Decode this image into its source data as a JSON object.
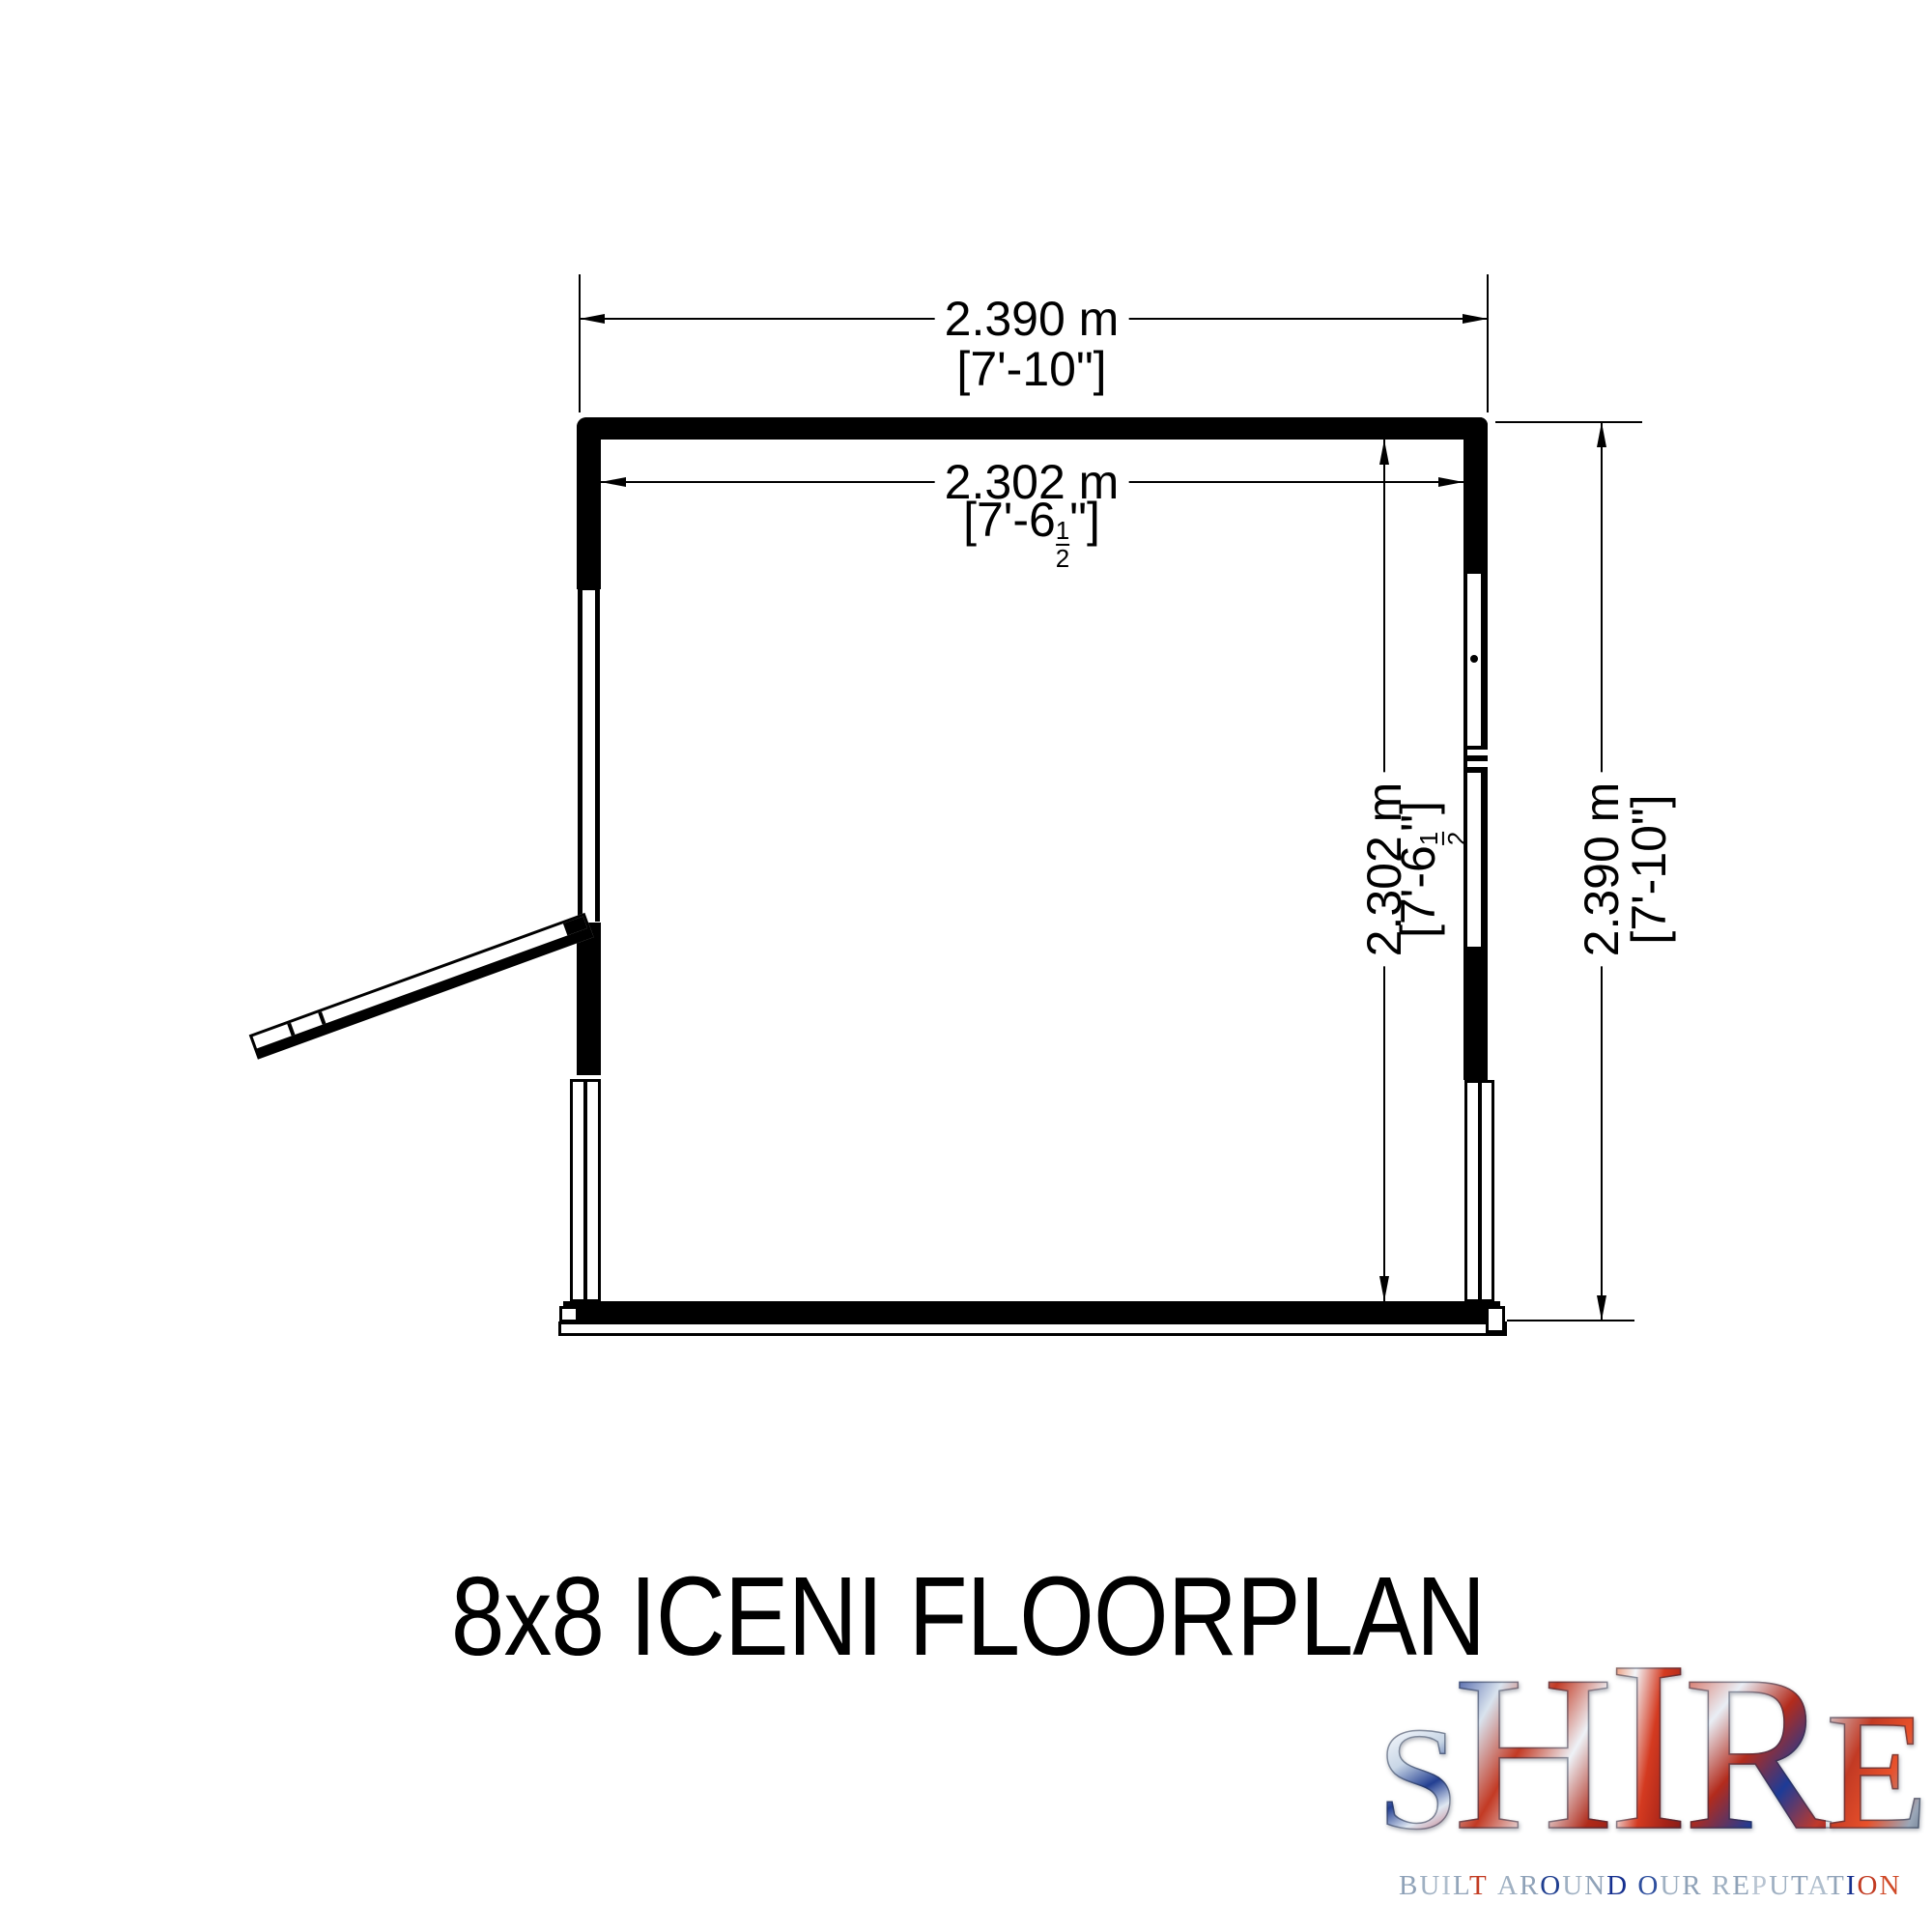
{
  "title": "8x8 ICENI FLOORPLAN",
  "dimensions": {
    "top": {
      "metric": "2.390 m",
      "imperial": {
        "pre": "[7'-10",
        "post": "\"]"
      }
    },
    "inner_width": {
      "metric": "2.302 m",
      "imperial": {
        "pre": "[7'-6",
        "num": "1",
        "den": "2",
        "post": "\"]"
      }
    },
    "inner_height": {
      "metric": "2.302 m",
      "imperial": {
        "pre": "[7'-6",
        "num": "1",
        "den": "2",
        "post": "\"]"
      }
    },
    "outer_height": {
      "metric": "2.390 m",
      "imperial": {
        "pre": "[7'-10",
        "post": "\"]"
      }
    }
  },
  "drawing": {
    "ink_color": "#000000",
    "paper_color": "#ffffff",
    "features": [
      "top-wall",
      "left-window",
      "open-door",
      "right-window-with-handle",
      "bottom-base-plate"
    ]
  },
  "logo": {
    "word": "SHIRE",
    "letters": [
      {
        "ch": "S",
        "size": 152,
        "angle": 150,
        "colors": [
          "#b8333f 0%",
          "#e8eef6 22%",
          "#c8d6e6 38%",
          "#233f92 58%",
          "#dfe8f2 74%",
          "#b23040 100%"
        ]
      },
      {
        "ch": "H",
        "size": 230,
        "angle": 120,
        "colors": [
          "#16308f 0%",
          "#d9e3ee 25%",
          "#c33a24 45%",
          "#eef2f7 65%",
          "#b02a1a 85%",
          "#8f1d14 100%"
        ]
      },
      {
        "ch": "I",
        "size": 252,
        "angle": 100,
        "colors": [
          "#e8632e 0%",
          "#f3f6fa 30%",
          "#d43a20 55%",
          "#a32218 80%",
          "#7e1a1a 100%"
        ]
      },
      {
        "ch": "R",
        "size": 230,
        "angle": 130,
        "colors": [
          "#d03b22 0%",
          "#e9eef5 28%",
          "#b32b1c 48%",
          "#1d3b97 68%",
          "#c0392b 88%",
          "#7e1020 100%"
        ]
      },
      {
        "ch": "E",
        "size": 174,
        "angle": 115,
        "colors": [
          "#d8e2ec 0%",
          "#c23a24 35%",
          "#e8502a 60%",
          "#9aa7b8 85%",
          "#5b6b80 100%"
        ]
      }
    ],
    "tagline": "BUILT AROUND OUR REPUTATION",
    "tagline_colors": [
      "#8fa2b8",
      "#9fb0c2",
      "#aebdcc",
      "#93a5ba",
      "#c23b22",
      "",
      "#9fb0c2",
      "#8fa2b8",
      "#1f3e8f",
      "#9fb0c2",
      "#8fa2b8",
      "#16308f",
      "",
      "#2e4f9e",
      "#9fb0c2",
      "#8fa2b8",
      "",
      "#9fb0c2",
      "#8fa2b8",
      "#b8c4d2",
      "#9fb0c2",
      "#8fa2b8",
      "#aebdcc",
      "#93a5ba",
      "#16308f",
      "#c23b22",
      "#d04a28"
    ]
  }
}
